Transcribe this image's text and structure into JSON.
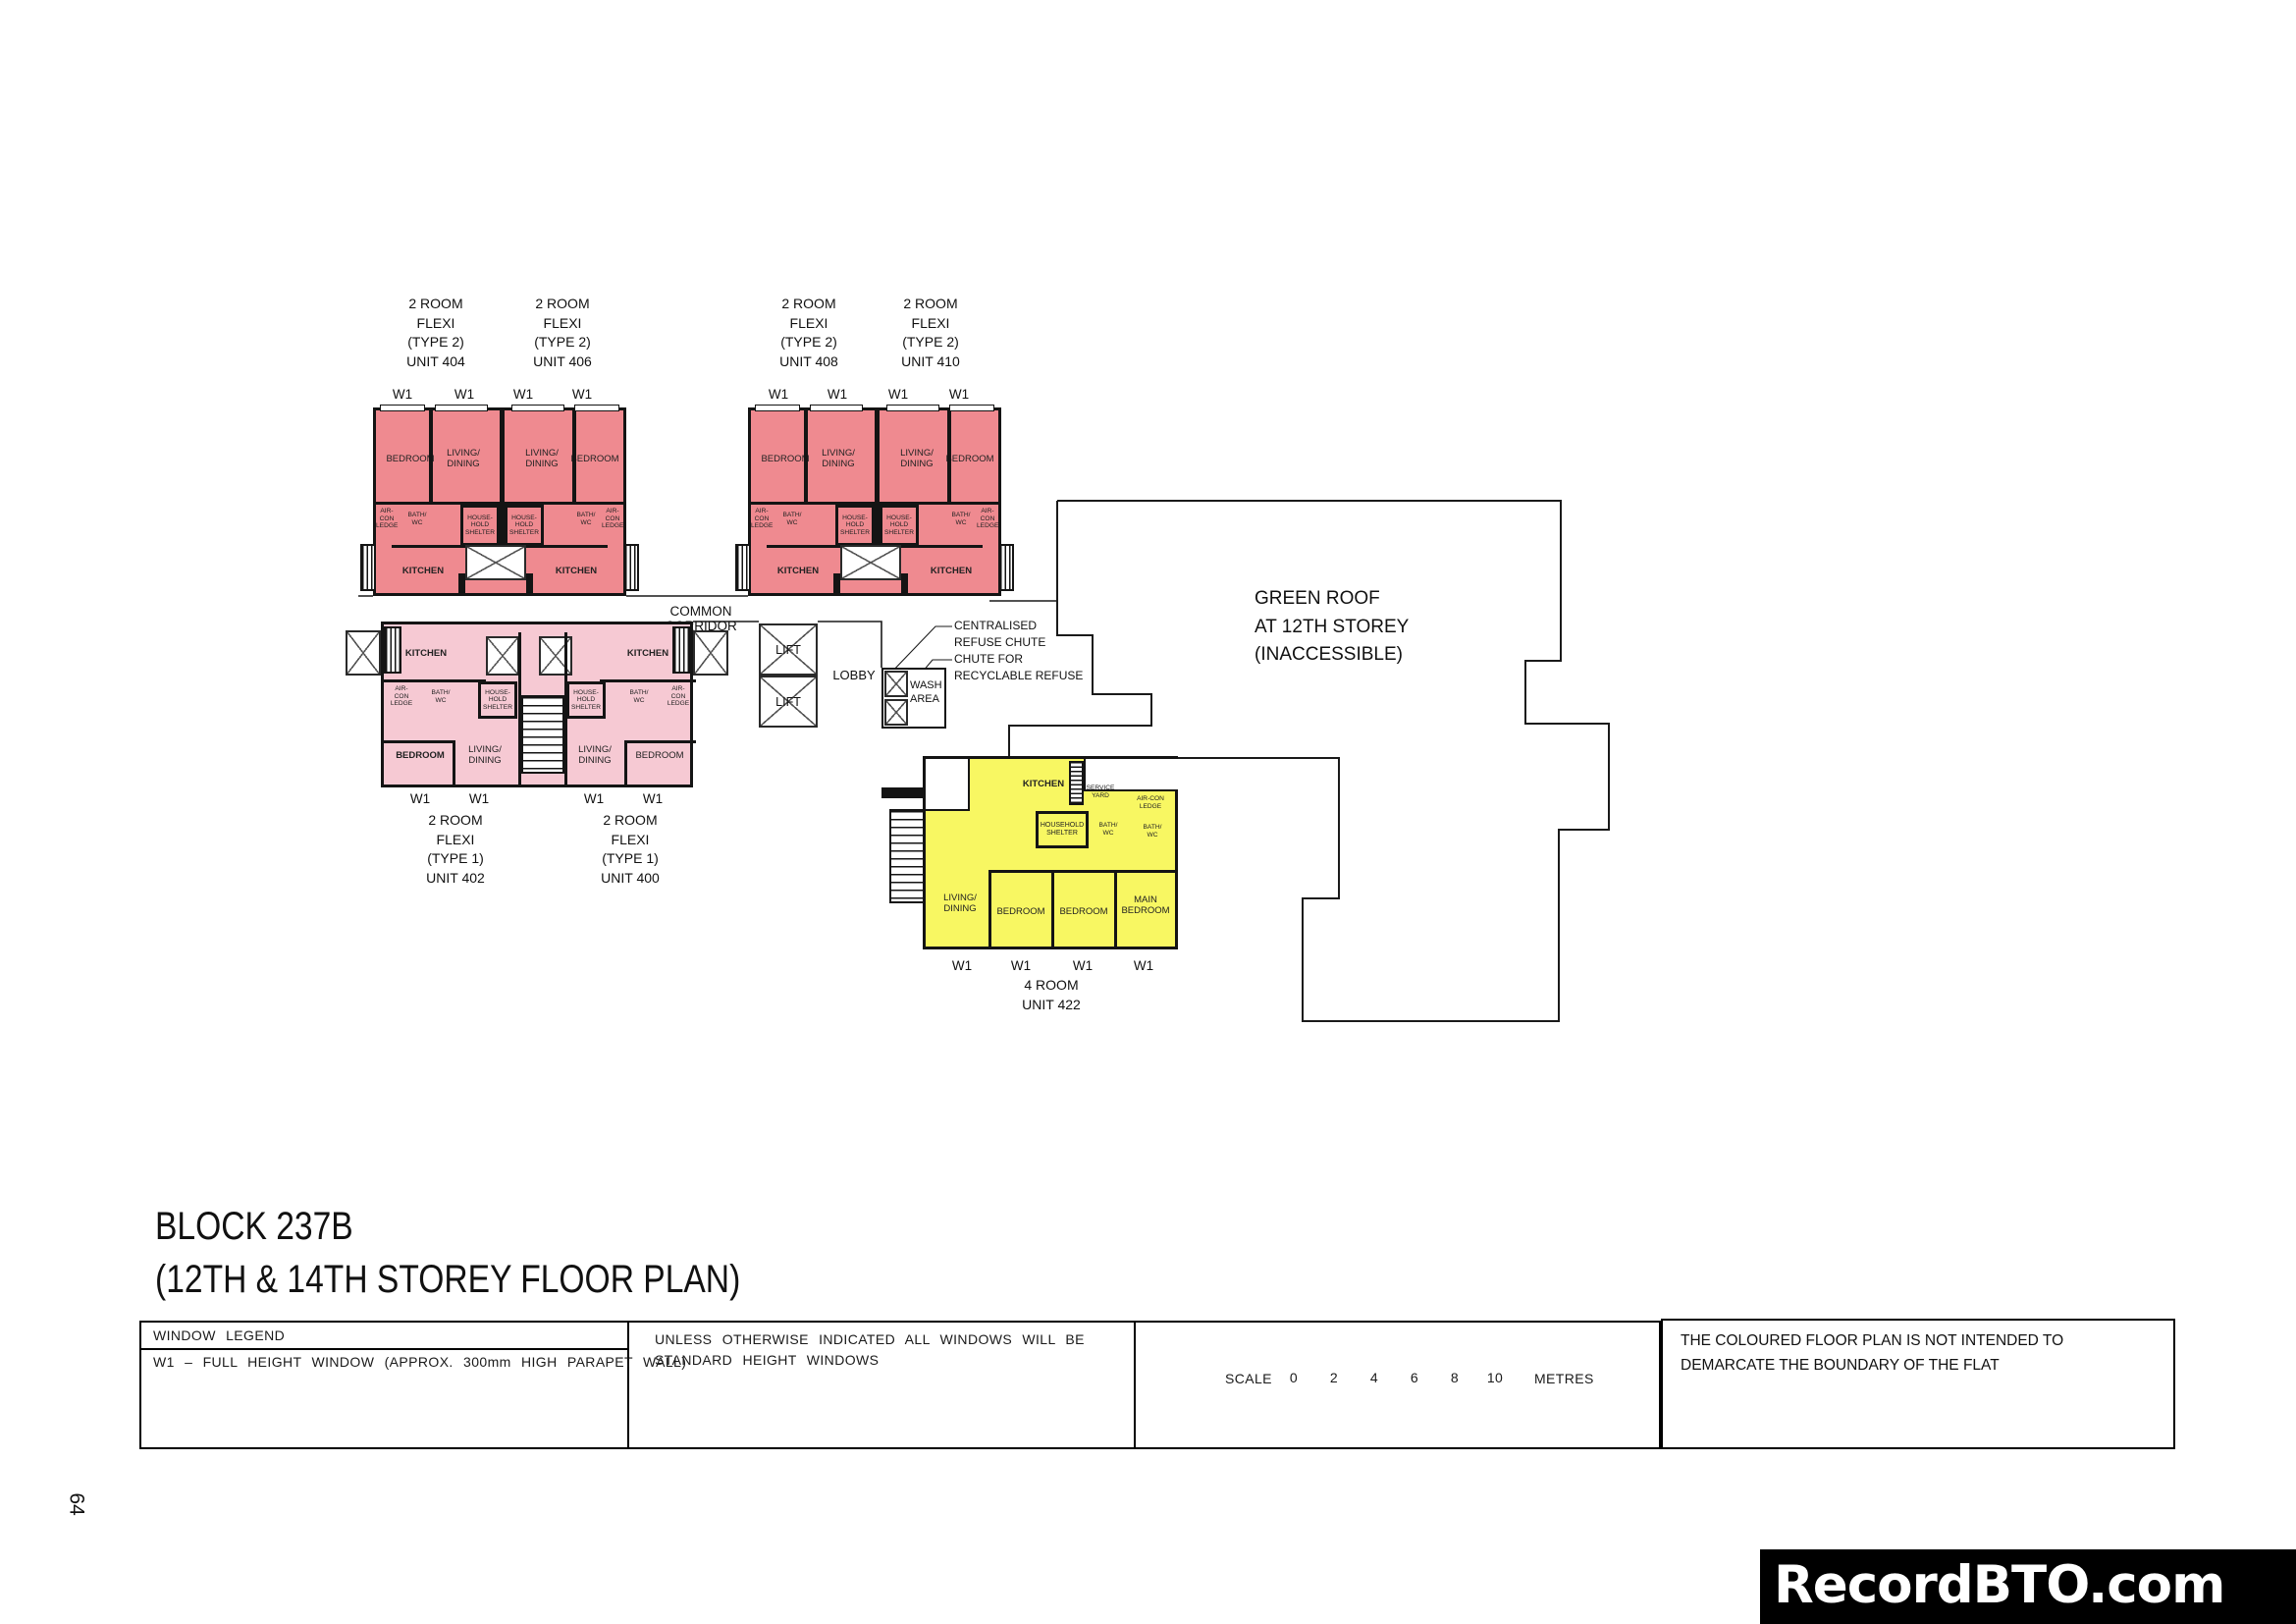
{
  "page_number": "64",
  "title": "BLOCK 237B\n(12TH & 14TH STOREY FLOOR PLAN)",
  "watermark": "RecordBTO.com",
  "legend": {
    "window_legend_title": "WINDOW LEGEND",
    "w1_definition": "W1 – FULL HEIGHT WINDOW (APPROX. 300mm HIGH PARAPET WALL)",
    "windows_note": "UNLESS OTHERWISE INDICATED ALL WINDOWS WILL BE\nSTANDARD HEIGHT WINDOWS",
    "scale_label": "SCALE",
    "scale_ticks": [
      "0",
      "2",
      "4",
      "6",
      "8",
      "10"
    ],
    "scale_unit": "METRES",
    "disclaimer": "THE COLOURED FLOOR PLAN IS NOT INTENDED TO\nDEMARCATE THE BOUNDARY OF THE FLAT"
  },
  "plan": {
    "common_corridor": "COMMON CORRIDOR",
    "lift": "LIFT",
    "lobby": "LOBBY",
    "wash_area": "WASH\nAREA",
    "green_roof_note": "GREEN ROOF\nAT 12TH STOREY\n(INACCESSIBLE)",
    "refuse_callout_1": "CENTRALISED\nREFUSE CHUTE",
    "refuse_callout_2": "CHUTE FOR\nRECYCLABLE REFUSE",
    "w1_label": "W1",
    "rooms": {
      "bedroom": "BEDROOM",
      "living_dining": "LIVING/\nDINING",
      "kitchen": "KITCHEN",
      "bath_wc": "BATH/\nWC",
      "household_shelter": "HOUSE-\nHOLD\nSHELTER",
      "household_shelter_wide": "HOUSEHOLD\nSHELTER",
      "aircon_ledge": "AIR-\nCON\nLEDGE",
      "aircon_ledge_wide": "AIR-CON\nLEDGE",
      "service_yard": "SERVICE\nYARD",
      "main_bedroom": "MAIN\nBEDROOM"
    },
    "units": {
      "u404": "2 ROOM\nFLEXI\n(TYPE 2)\nUNIT 404",
      "u406": "2 ROOM\nFLEXI\n(TYPE 2)\nUNIT 406",
      "u408": "2 ROOM\nFLEXI\n(TYPE 2)\nUNIT 408",
      "u410": "2 ROOM\nFLEXI\n(TYPE 2)\nUNIT 410",
      "u402": "2 ROOM\nFLEXI\n(TYPE 1)\nUNIT 402",
      "u400": "2 ROOM\nFLEXI\n(TYPE 1)\nUNIT 400",
      "u422": "4 ROOM\nUNIT 422"
    }
  },
  "colors": {
    "two_room_type2_fill": "#EF8A90",
    "two_room_type1_fill": "#F6C9D3",
    "four_room_fill": "#F8F762",
    "wall": "#141414",
    "watermark_bg": "#000000",
    "watermark_text": "#FFFFFF"
  }
}
